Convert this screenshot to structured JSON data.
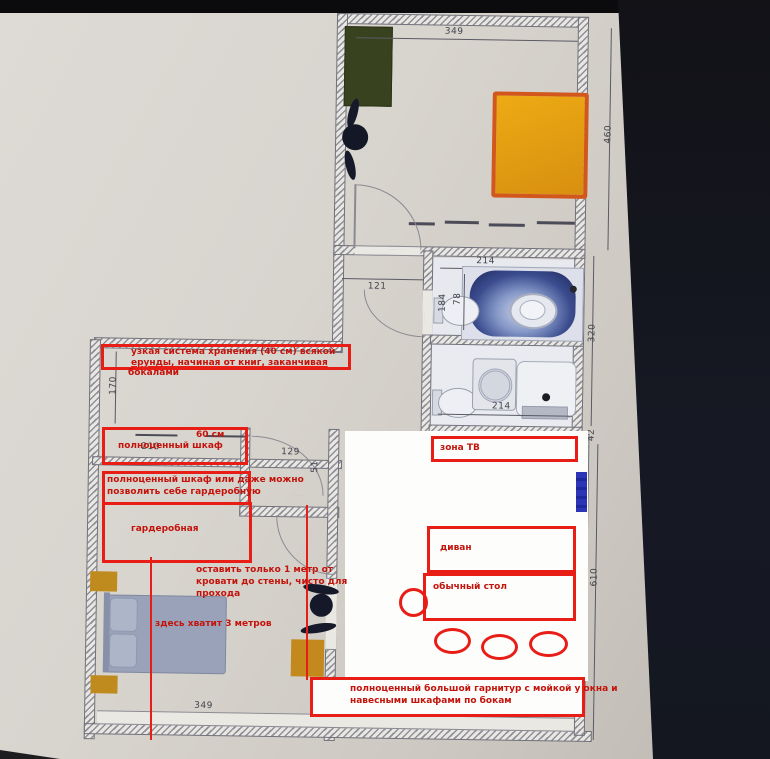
{
  "annotations": {
    "storage": {
      "line1": "узкая система хранения (40 см) всякой",
      "line2": "ерунды, начиная от книг, заканчивая",
      "line3": "бокалами"
    },
    "wardrobe60": {
      "label": "полноценный шкаф",
      "size": "60 см"
    },
    "wardrobe_or": {
      "line1": "полноценный шкаф или даже можно",
      "line2": "позволить себе гардеробную"
    },
    "dressing": "гардеробная",
    "passage": {
      "line1": "оставить только 1 метр от",
      "line2": "кровати до стены, чисто для",
      "line3": "прохода"
    },
    "bed_note": "здесь хватит 3 метров",
    "tv": "зона ТВ",
    "sofa": "диван",
    "table": "обычный стол",
    "kitchen": {
      "line1": "полноценный большой гарнитур с мойкой у окна и",
      "line2": "навесными шкафами по бокам"
    }
  },
  "dimensions": {
    "top_width": "349",
    "upper_right_height": "460",
    "bath_width": "214",
    "bath_length": "184",
    "bath_gap": "78",
    "hall_width": "121",
    "closet_width": "129",
    "closet_depth": "51",
    "left_height": "170",
    "wardrobe_width": "210",
    "lower_bath_width": "214",
    "mid_right_height": "320",
    "corridor": "42",
    "bottom_width": "349",
    "right_height": "610"
  },
  "colors": {
    "annotation_red": "#e81d16",
    "paper": "#d8d4ce",
    "orange_rug": "#e3a015",
    "green_cabinet": "#39421e",
    "bed_gray": "#99a2b9",
    "tub_blue": "#27316b",
    "radiator_blue": "#2c35b5"
  }
}
